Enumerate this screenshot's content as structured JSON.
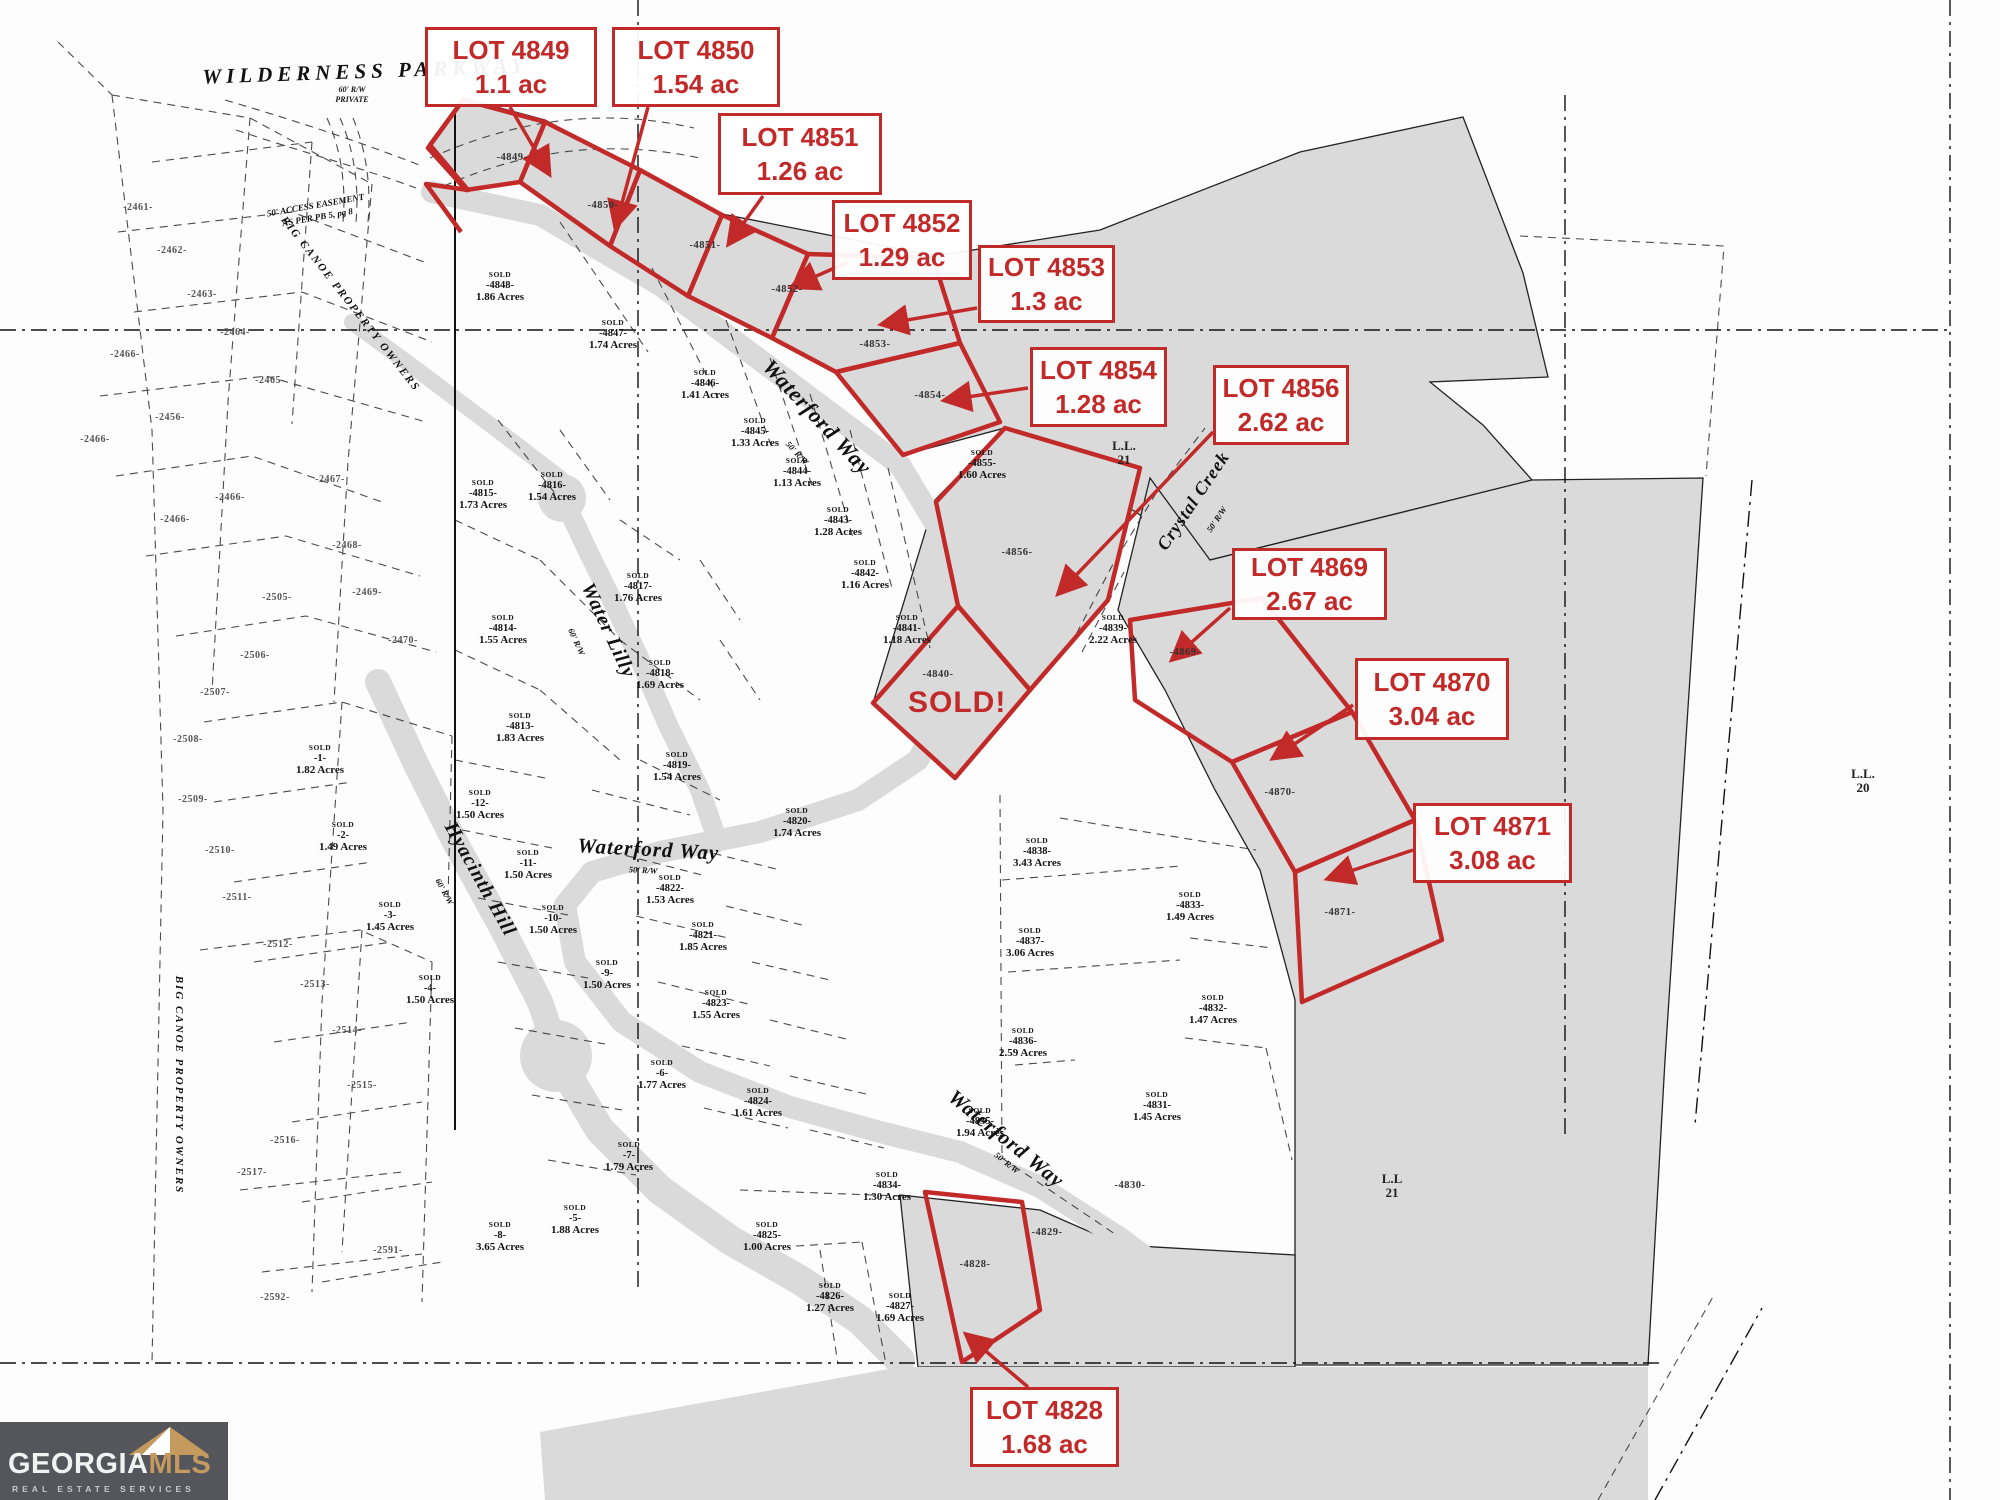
{
  "colors": {
    "callout_red": "#c22a2a",
    "tract_gray": "#dadada",
    "logo_bg": "#54565b",
    "logo_gold": "#c49a5f"
  },
  "callouts": [
    {
      "lot": "LOT 4849",
      "area": "1.1 ac"
    },
    {
      "lot": "LOT 4850",
      "area": "1.54 ac"
    },
    {
      "lot": "LOT 4851",
      "area": "1.26 ac"
    },
    {
      "lot": "LOT 4852",
      "area": "1.29 ac"
    },
    {
      "lot": "LOT 4853",
      "area": "1.3 ac"
    },
    {
      "lot": "LOT 4854",
      "area": "1.28 ac"
    },
    {
      "lot": "LOT 4856",
      "area": "2.62 ac"
    },
    {
      "lot": "LOT 4869",
      "area": "2.67 ac"
    },
    {
      "lot": "LOT 4870",
      "area": "3.04 ac"
    },
    {
      "lot": "LOT 4871",
      "area": "3.08 ac"
    },
    {
      "lot": "LOT 4828",
      "area": "1.68 ac"
    }
  ],
  "map": {
    "sold_overlay": {
      "text": "SOLD!",
      "x": 908,
      "y": 686
    },
    "streets": [
      {
        "text": "WILDERNESS  PARKWAY",
        "x": 366,
        "y": 78,
        "rot": -2,
        "size": 21,
        "ls": 5
      },
      {
        "text": "60' R/W",
        "x": 352,
        "y": 92,
        "rot": 0,
        "size": 8,
        "ls": 0
      },
      {
        "text": "PRIVATE",
        "x": 352,
        "y": 102,
        "rot": 0,
        "size": 8,
        "ls": 0
      },
      {
        "text": "50' ACCESS EASEMENT",
        "x": 316,
        "y": 208,
        "rot": -10,
        "size": 9,
        "ls": 0
      },
      {
        "text": "AS PER PB 5, pg 8",
        "x": 318,
        "y": 220,
        "rot": -10,
        "size": 9,
        "ls": 0
      },
      {
        "text": "BIG CANOE PROPERTY OWNERS",
        "x": 348,
        "y": 306,
        "rot": 52,
        "size": 11,
        "ls": 2
      },
      {
        "text": "BIG CANOE PROPERTY OWNERS",
        "x": 176,
        "y": 1085,
        "rot": 90,
        "size": 11,
        "ls": 2
      },
      {
        "text": "Waterford Way",
        "x": 812,
        "y": 422,
        "rot": 47,
        "size": 22,
        "ls": 1
      },
      {
        "text": "50' R/W",
        "x": 795,
        "y": 455,
        "rot": 47,
        "size": 8.5,
        "ls": 0
      },
      {
        "text": "Water Lilly",
        "x": 603,
        "y": 633,
        "rot": 65,
        "size": 20,
        "ls": 1
      },
      {
        "text": "60' R/W",
        "x": 574,
        "y": 643,
        "rot": 65,
        "size": 8.5,
        "ls": 0
      },
      {
        "text": "Hyacinth Hill",
        "x": 475,
        "y": 882,
        "rot": 61,
        "size": 20,
        "ls": 1
      },
      {
        "text": "60' R/W",
        "x": 442,
        "y": 893,
        "rot": 61,
        "size": 8.5,
        "ls": 0
      },
      {
        "text": "Waterford Way",
        "x": 648,
        "y": 856,
        "rot": 3,
        "size": 21,
        "ls": 1
      },
      {
        "text": "50' R/W",
        "x": 643,
        "y": 873,
        "rot": 3,
        "size": 8.5,
        "ls": 0
      },
      {
        "text": "Waterford Way",
        "x": 1002,
        "y": 1144,
        "rot": 39,
        "size": 21,
        "ls": 1
      },
      {
        "text": "50' R/W",
        "x": 1005,
        "y": 1165,
        "rot": 39,
        "size": 8.5,
        "ls": 0
      },
      {
        "text": "Crystal Creek",
        "x": 1198,
        "y": 504,
        "rot": -56,
        "size": 18,
        "ls": 1
      },
      {
        "text": "50' R/W",
        "x": 1219,
        "y": 521,
        "rot": -56,
        "size": 8.5,
        "ls": 0
      }
    ],
    "landlots": [
      {
        "l1": "L.L.",
        "l2": "21",
        "x": 1124,
        "y": 450
      },
      {
        "l1": "L.L.",
        "l2": "20",
        "x": 1863,
        "y": 778
      },
      {
        "l1": "L.L",
        "l2": "21",
        "x": 1392,
        "y": 1183
      }
    ],
    "parcels": [
      {
        "sold": "SOLD",
        "id": "-4848-",
        "acres": "1.86 Acres",
        "x": 500,
        "y": 277
      },
      {
        "sold": "SOLD",
        "id": "-4847-",
        "acres": "1.74 Acres",
        "x": 613,
        "y": 325
      },
      {
        "sold": "SOLD",
        "id": "-4846-",
        "acres": "1.41 Acres",
        "x": 705,
        "y": 375
      },
      {
        "sold": "SOLD",
        "id": "-4845-",
        "acres": "1.33 Acres",
        "x": 755,
        "y": 423
      },
      {
        "sold": "SOLD",
        "id": "-4844-",
        "acres": "1.13 Acres",
        "x": 797,
        "y": 463
      },
      {
        "sold": "SOLD",
        "id": "-4843-",
        "acres": "1.28 Acres",
        "x": 838,
        "y": 512
      },
      {
        "sold": "SOLD",
        "id": "-4842-",
        "acres": "1.16 Acres",
        "x": 865,
        "y": 565
      },
      {
        "sold": "SOLD",
        "id": "-4841-",
        "acres": "1.18 Acres",
        "x": 907,
        "y": 620
      },
      {
        "sold": "SOLD",
        "id": "-4855-",
        "acres": "1.60 Acres",
        "x": 982,
        "y": 455
      },
      {
        "sold": "SOLD",
        "id": "-4839-",
        "acres": "2.22 Acres",
        "x": 1113,
        "y": 620
      },
      {
        "sold": "SOLD",
        "id": "-4815-",
        "acres": "1.73 Acres",
        "x": 483,
        "y": 485
      },
      {
        "sold": "SOLD",
        "id": "-4816-",
        "acres": "1.54 Acres",
        "x": 552,
        "y": 477
      },
      {
        "sold": "SOLD",
        "id": "-4817-",
        "acres": "1.76 Acres",
        "x": 638,
        "y": 578
      },
      {
        "sold": "SOLD",
        "id": "-4814-",
        "acres": "1.55 Acres",
        "x": 503,
        "y": 620
      },
      {
        "sold": "SOLD",
        "id": "-4818-",
        "acres": "1.69 Acres",
        "x": 660,
        "y": 665
      },
      {
        "sold": "SOLD",
        "id": "-4813-",
        "acres": "1.83 Acres",
        "x": 520,
        "y": 718
      },
      {
        "sold": "SOLD",
        "id": "-4819-",
        "acres": "1.54 Acres",
        "x": 677,
        "y": 757
      },
      {
        "sold": "SOLD",
        "id": "-1-",
        "acres": "1.82 Acres",
        "x": 320,
        "y": 750
      },
      {
        "sold": "SOLD",
        "id": "-12-",
        "acres": "1.50 Acres",
        "x": 480,
        "y": 795
      },
      {
        "sold": "SOLD",
        "id": "-2-",
        "acres": "1.49 Acres",
        "x": 343,
        "y": 827
      },
      {
        "sold": "SOLD",
        "id": "-11-",
        "acres": "1.50 Acres",
        "x": 528,
        "y": 855
      },
      {
        "sold": "SOLD",
        "id": "-3-",
        "acres": "1.45 Acres",
        "x": 390,
        "y": 907
      },
      {
        "sold": "SOLD",
        "id": "-10-",
        "acres": "1.50 Acres",
        "x": 553,
        "y": 910
      },
      {
        "sold": "SOLD",
        "id": "-4-",
        "acres": "1.50 Acres",
        "x": 430,
        "y": 980
      },
      {
        "sold": "SOLD",
        "id": "-9-",
        "acres": "1.50 Acres",
        "x": 607,
        "y": 965
      },
      {
        "sold": "SOLD",
        "id": "-4822-",
        "acres": "1.53 Acres",
        "x": 670,
        "y": 880
      },
      {
        "sold": "SOLD",
        "id": "-4821-",
        "acres": "1.85 Acres",
        "x": 703,
        "y": 927
      },
      {
        "sold": "SOLD",
        "id": "-4820-",
        "acres": "1.74 Acres",
        "x": 797,
        "y": 813
      },
      {
        "sold": "SOLD",
        "id": "-4823-",
        "acres": "1.55 Acres",
        "x": 716,
        "y": 995
      },
      {
        "sold": "SOLD",
        "id": "-6-",
        "acres": "1.77 Acres",
        "x": 662,
        "y": 1065
      },
      {
        "sold": "SOLD",
        "id": "-4824-",
        "acres": "1.61 Acres",
        "x": 758,
        "y": 1093
      },
      {
        "sold": "SOLD",
        "id": "-7-",
        "acres": "1.79 Acres",
        "x": 629,
        "y": 1147
      },
      {
        "sold": "SOLD",
        "id": "-5-",
        "acres": "1.88 Acres",
        "x": 575,
        "y": 1210
      },
      {
        "sold": "SOLD",
        "id": "-8-",
        "acres": "3.65 Acres",
        "x": 500,
        "y": 1227
      },
      {
        "sold": "SOLD",
        "id": "-4825-",
        "acres": "1.00 Acres",
        "x": 767,
        "y": 1227
      },
      {
        "sold": "SOLD",
        "id": "-4826-",
        "acres": "1.27 Acres",
        "x": 830,
        "y": 1288
      },
      {
        "sold": "SOLD",
        "id": "-4827-",
        "acres": "1.69 Acres",
        "x": 900,
        "y": 1298
      },
      {
        "sold": "SOLD",
        "id": "-4834-",
        "acres": "1.30 Acres",
        "x": 887,
        "y": 1177
      },
      {
        "sold": "SOLD",
        "id": "-4835-",
        "acres": "1.94 Acres",
        "x": 980,
        "y": 1113
      },
      {
        "sold": "SOLD",
        "id": "-4836-",
        "acres": "2.59 Acres",
        "x": 1023,
        "y": 1033
      },
      {
        "sold": "SOLD",
        "id": "-4837-",
        "acres": "3.06 Acres",
        "x": 1030,
        "y": 933
      },
      {
        "sold": "SOLD",
        "id": "-4838-",
        "acres": "3.43 Acres",
        "x": 1037,
        "y": 843
      },
      {
        "sold": "SOLD",
        "id": "-4831-",
        "acres": "1.45 Acres",
        "x": 1157,
        "y": 1097
      },
      {
        "sold": "SOLD",
        "id": "-4832-",
        "acres": "1.47 Acres",
        "x": 1213,
        "y": 1000
      },
      {
        "sold": "SOLD",
        "id": "-4833-",
        "acres": "1.49 Acres",
        "x": 1190,
        "y": 897
      }
    ],
    "graylots": [
      {
        "id": "-4849-",
        "x": 512,
        "y": 160
      },
      {
        "id": "-4850-",
        "x": 603,
        "y": 208
      },
      {
        "id": "-4851-",
        "x": 705,
        "y": 248
      },
      {
        "id": "-4852-",
        "x": 787,
        "y": 292
      },
      {
        "id": "-4853-",
        "x": 875,
        "y": 347
      },
      {
        "id": "-4854-",
        "x": 930,
        "y": 398
      },
      {
        "id": "-4856-",
        "x": 1017,
        "y": 555
      },
      {
        "id": "-4840-",
        "x": 938,
        "y": 677
      },
      {
        "id": "-4869-",
        "x": 1185,
        "y": 655
      },
      {
        "id": "-4870-",
        "x": 1280,
        "y": 795
      },
      {
        "id": "-4871-",
        "x": 1340,
        "y": 915
      },
      {
        "id": "-4828-",
        "x": 975,
        "y": 1267
      },
      {
        "id": "-4829-",
        "x": 1047,
        "y": 1235
      },
      {
        "id": "-4830-",
        "x": 1130,
        "y": 1188
      }
    ],
    "outparcels": [
      {
        "id": "-2461-",
        "x": 138,
        "y": 210
      },
      {
        "id": "-2462-",
        "x": 172,
        "y": 253
      },
      {
        "id": "-2463-",
        "x": 202,
        "y": 297
      },
      {
        "id": "-2464-",
        "x": 235,
        "y": 335
      },
      {
        "id": "-2465-",
        "x": 270,
        "y": 383
      },
      {
        "id": "-2466-",
        "x": 125,
        "y": 357
      },
      {
        "id": "-2466-",
        "x": 95,
        "y": 442
      },
      {
        "id": "-2456-",
        "x": 170,
        "y": 420
      },
      {
        "id": "-2466-",
        "x": 230,
        "y": 500
      },
      {
        "id": "-2467-",
        "x": 330,
        "y": 482
      },
      {
        "id": "-2466-",
        "x": 175,
        "y": 522
      },
      {
        "id": "-2468-",
        "x": 347,
        "y": 548
      },
      {
        "id": "-2469-",
        "x": 367,
        "y": 595
      },
      {
        "id": "-2470-",
        "x": 403,
        "y": 643
      },
      {
        "id": "-2505-",
        "x": 277,
        "y": 600
      },
      {
        "id": "-2506-",
        "x": 255,
        "y": 658
      },
      {
        "id": "-2507-",
        "x": 215,
        "y": 695
      },
      {
        "id": "-2508-",
        "x": 188,
        "y": 742
      },
      {
        "id": "-2509-",
        "x": 193,
        "y": 802
      },
      {
        "id": "-2510-",
        "x": 220,
        "y": 853
      },
      {
        "id": "-2511-",
        "x": 237,
        "y": 900
      },
      {
        "id": "-2512-",
        "x": 278,
        "y": 947
      },
      {
        "id": "-2513-",
        "x": 315,
        "y": 987
      },
      {
        "id": "-2514-",
        "x": 347,
        "y": 1033
      },
      {
        "id": "-2515-",
        "x": 362,
        "y": 1088
      },
      {
        "id": "-2516-",
        "x": 285,
        "y": 1143
      },
      {
        "id": "-2517-",
        "x": 252,
        "y": 1175
      },
      {
        "id": "-2591-",
        "x": 388,
        "y": 1253
      },
      {
        "id": "-2592-",
        "x": 275,
        "y": 1300
      }
    ]
  },
  "logo": {
    "name_a": "GEORGIA",
    "name_b": "MLS",
    "tagline": "REAL ESTATE SERVICES"
  }
}
